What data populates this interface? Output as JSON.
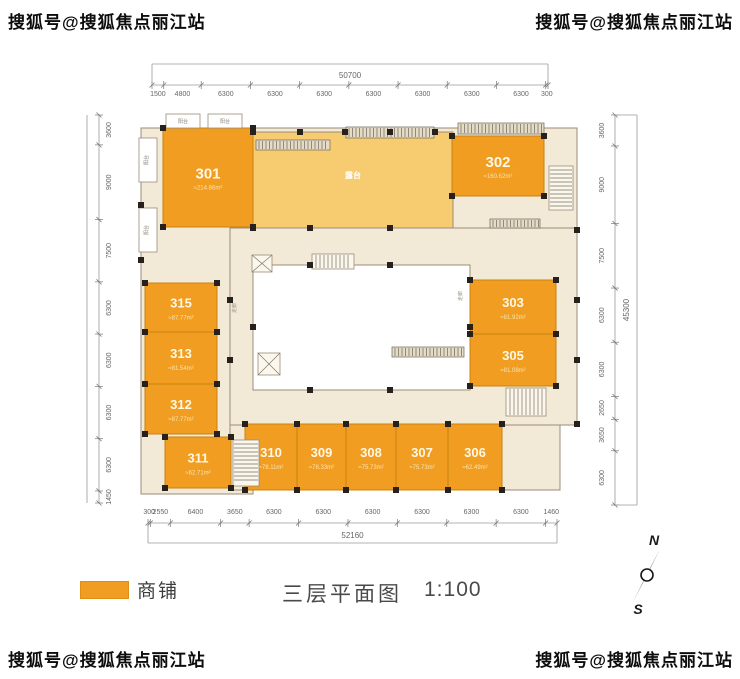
{
  "watermarks": {
    "top_left": "搜狐号@搜狐焦点丽江站",
    "top_right": "搜狐号@搜狐焦点丽江站",
    "bottom_left": "搜狐号@搜狐焦点丽江站",
    "bottom_right": "搜狐号@搜狐焦点丽江站"
  },
  "legend": {
    "label": "商铺"
  },
  "title": {
    "text": "三层平面图",
    "scale": "1:100"
  },
  "compass": {
    "north": "N",
    "south": "S"
  },
  "plan_labels": {
    "terrace": "露台",
    "balcony": "阳台",
    "corridor": "走廊"
  },
  "colors": {
    "shop": "#F09D21",
    "terrace": "#F7CB6F",
    "corridor": "#F3E9D7",
    "atrium": "#FFFFFF",
    "wall": "#9B8C79",
    "column": "#26211C",
    "dim_text": "#666666",
    "dim_line": "#9a9a9a",
    "room_number": "#FFF8E6",
    "room_area": "#FBE3B0"
  },
  "dimensions": {
    "top": {
      "total": "50700",
      "segments": [
        "1500",
        "4800",
        "6300",
        "6300",
        "6300",
        "6300",
        "6300",
        "6300",
        "6300",
        "300"
      ]
    },
    "bottom": {
      "total": "52160",
      "segments": [
        "300",
        "2550",
        "6400",
        "3650",
        "6300",
        "6300",
        "6300",
        "6300",
        "6300",
        "6300",
        "1460"
      ]
    },
    "left": {
      "segments": [
        "3600",
        "9000",
        "7500",
        "6300",
        "6300",
        "6300",
        "6300",
        "1450"
      ]
    },
    "right": {
      "total": "45300",
      "segments": [
        "3600",
        "9000",
        "7500",
        "6300",
        "6300",
        "2650",
        "3650",
        "6300"
      ]
    }
  },
  "rooms": [
    {
      "id": "301",
      "area": "≈214.86m²"
    },
    {
      "id": "302",
      "area": "≈160.62m²"
    },
    {
      "id": "303",
      "area": "≈81.92m²"
    },
    {
      "id": "305",
      "area": "≈81.08m²"
    },
    {
      "id": "306",
      "area": "≈62.49m²"
    },
    {
      "id": "307",
      "area": "≈75.73m²"
    },
    {
      "id": "308",
      "area": "≈75.73m²"
    },
    {
      "id": "309",
      "area": "≈78.33m²"
    },
    {
      "id": "310",
      "area": "≈78.11m²"
    },
    {
      "id": "311",
      "area": "≈62.71m²"
    },
    {
      "id": "312",
      "area": "≈87.77m²"
    },
    {
      "id": "313",
      "area": "≈81.54m²"
    },
    {
      "id": "315",
      "area": "≈87.77m²"
    }
  ]
}
